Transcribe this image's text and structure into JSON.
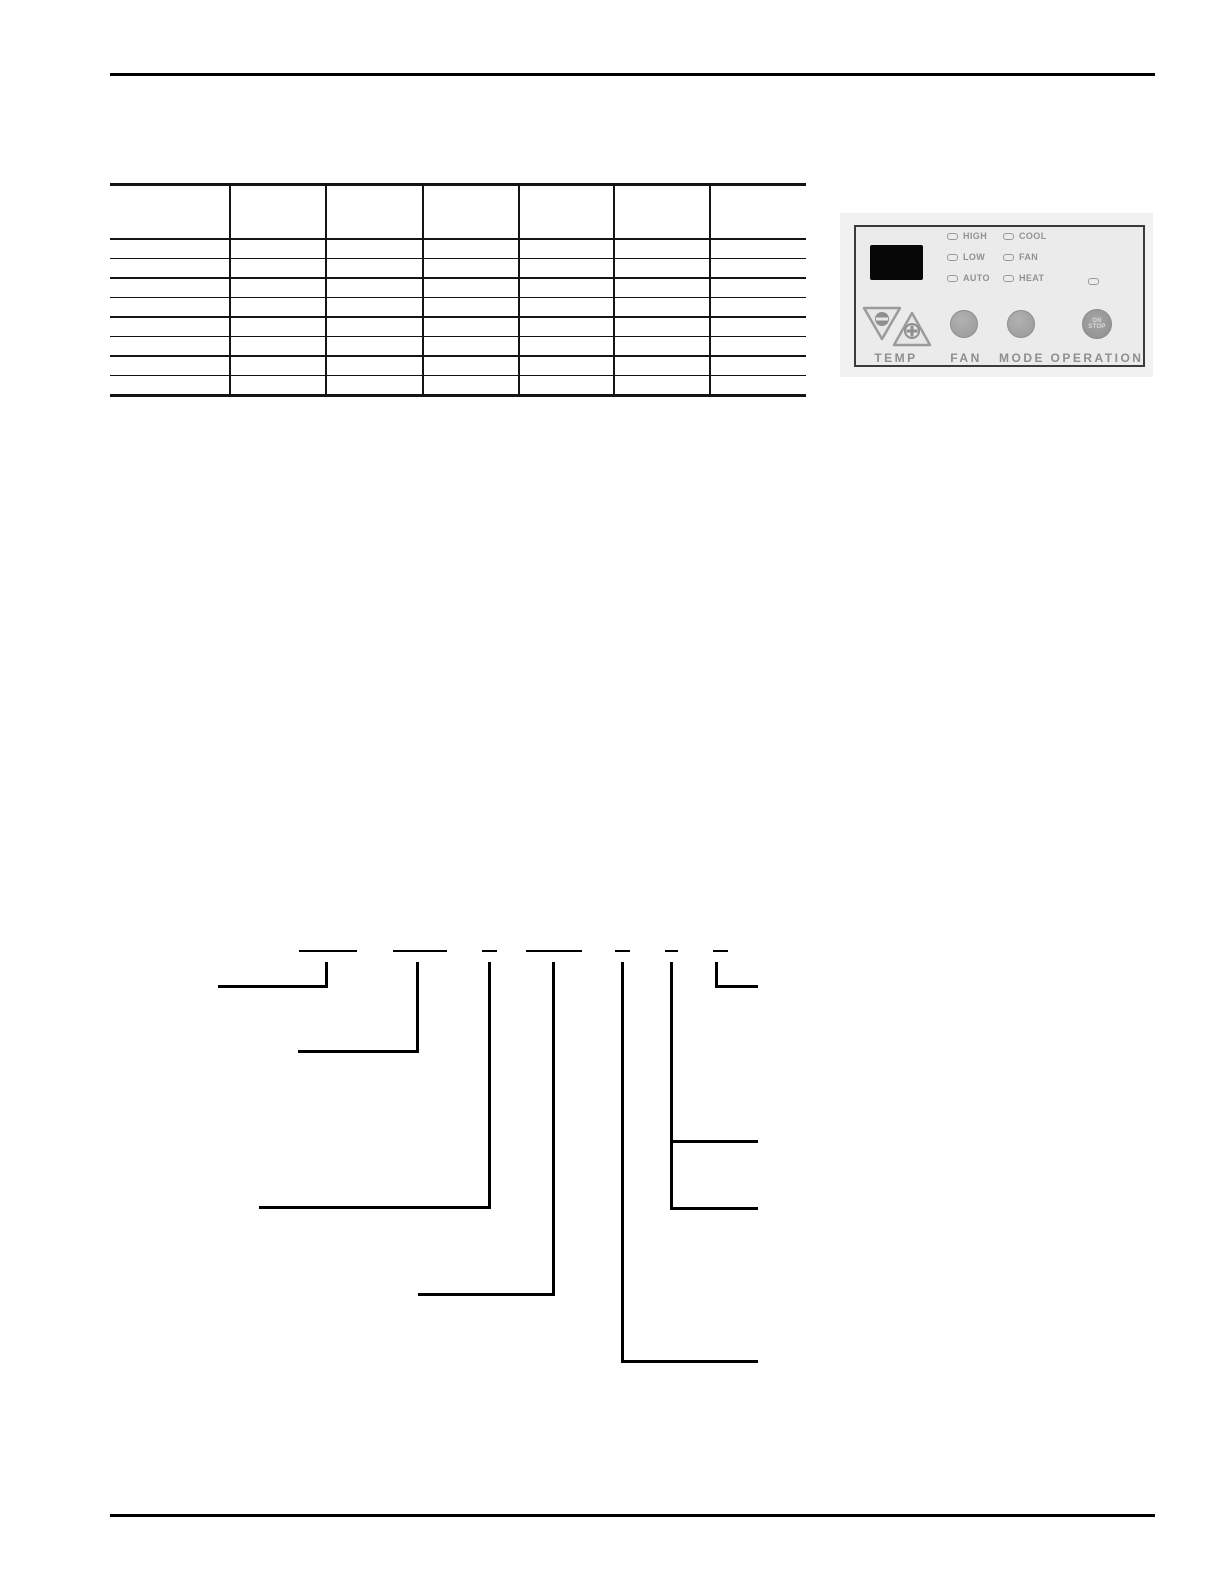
{
  "page": {
    "background": "#ffffff"
  },
  "rules": {
    "color": "#000000",
    "top": {
      "x": 110,
      "y": 73,
      "width": 1045,
      "height": 3
    },
    "bottom": {
      "x": 110,
      "y": 1514,
      "width": 1045,
      "height": 3
    }
  },
  "table": {
    "x": 110,
    "y": 183,
    "width": 696,
    "height": 211,
    "header_height": 55,
    "row_height": 19.5,
    "border_color": "#141414",
    "column_dividers": [
      119,
      215,
      312,
      408,
      503,
      599
    ],
    "columns": [
      "",
      "",
      "",
      "",
      "",
      "",
      ""
    ],
    "rows": [
      [
        "",
        "",
        "",
        "",
        "",
        "",
        ""
      ],
      [
        "",
        "",
        "",
        "",
        "",
        "",
        ""
      ],
      [
        "",
        "",
        "",
        "",
        "",
        "",
        ""
      ],
      [
        "",
        "",
        "",
        "",
        "",
        "",
        ""
      ],
      [
        "",
        "",
        "",
        "",
        "",
        "",
        ""
      ],
      [
        "",
        "",
        "",
        "",
        "",
        "",
        ""
      ],
      [
        "",
        "",
        "",
        "",
        "",
        "",
        ""
      ],
      [
        "",
        "",
        "",
        "",
        "",
        "",
        ""
      ]
    ]
  },
  "control_panel": {
    "photo_bg": "#f1f1f1",
    "panel_bg": "#ebebeb",
    "panel_border": "#3b3b3b",
    "text_color": "#8f8f8f",
    "display_color": "#070707",
    "fan_speed_leds": [
      "HIGH",
      "LOW",
      "AUTO"
    ],
    "mode_leds": [
      "COOL",
      "FAN",
      "HEAT"
    ],
    "buttons": {
      "temp_label": "TEMP",
      "fan_label": "FAN",
      "mode_label": "MODE",
      "operation_label": "OPERATION",
      "operation_button_text": [
        "ON",
        "STOP"
      ]
    }
  },
  "diagram": {
    "color": "#000000",
    "underline_thickness": 2,
    "line_thickness": 3,
    "underlines": [
      {
        "x": 299,
        "y": 950,
        "w": 58
      },
      {
        "x": 393,
        "y": 950,
        "w": 54
      },
      {
        "x": 482,
        "y": 950,
        "w": 15
      },
      {
        "x": 526,
        "y": 950,
        "w": 56
      },
      {
        "x": 615,
        "y": 950,
        "w": 15
      },
      {
        "x": 665,
        "y": 950,
        "w": 13
      },
      {
        "x": 713,
        "y": 950,
        "w": 15
      }
    ],
    "verticals": [
      {
        "x": 326,
        "y1": 962,
        "y2": 988
      },
      {
        "x": 417,
        "y1": 962,
        "y2": 1053
      },
      {
        "x": 489,
        "y1": 962,
        "y2": 1209
      },
      {
        "x": 553,
        "y1": 962,
        "y2": 1296
      },
      {
        "x": 622,
        "y1": 962,
        "y2": 1363
      },
      {
        "x": 671,
        "y1": 962,
        "y2": 1210
      },
      {
        "x": 716,
        "y1": 962,
        "y2": 988
      }
    ],
    "horizontals": [
      {
        "x1": 218,
        "x2": 328,
        "y": 985
      },
      {
        "x1": 298,
        "x2": 419,
        "y": 1050
      },
      {
        "x1": 259,
        "x2": 491,
        "y": 1206
      },
      {
        "x1": 418,
        "x2": 555,
        "y": 1293
      },
      {
        "x1": 622,
        "x2": 758,
        "y": 1360
      },
      {
        "x1": 671,
        "x2": 758,
        "y": 1140
      },
      {
        "x1": 671,
        "x2": 758,
        "y": 1207
      },
      {
        "x1": 716,
        "x2": 758,
        "y": 985
      }
    ]
  }
}
